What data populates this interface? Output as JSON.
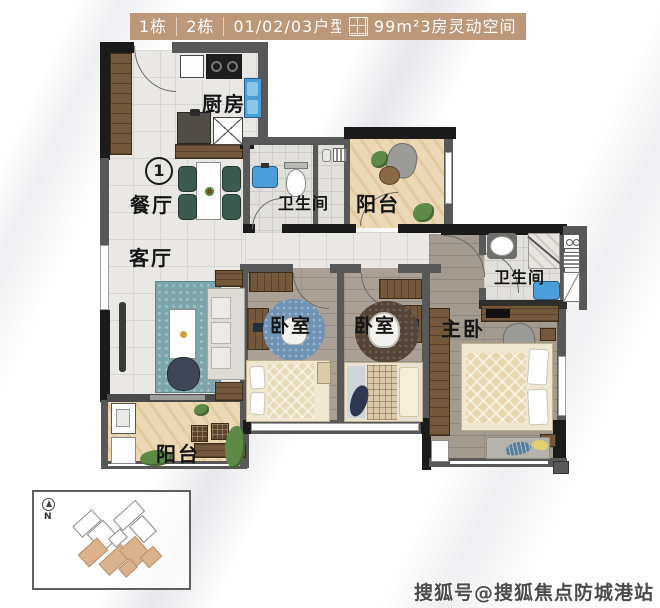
{
  "header": {
    "tabs": [
      "1栋",
      "2栋",
      "01/02/03户型"
    ],
    "area_text": "99m²3房灵动空间",
    "accent_color": "#bc9778"
  },
  "plan": {
    "unit_marker": "1",
    "compass": "N",
    "labels": {
      "kitchen": "厨房",
      "dining": "餐厅",
      "living": "客厅",
      "bathroom": "卫生间",
      "balcony": "阳台",
      "bedroom": "卧室",
      "master_bedroom": "主卧"
    }
  },
  "watermark": "搜狐号@搜狐焦点防城港站",
  "colors": {
    "wall": "#585858",
    "wall_dark": "#1b1b1b",
    "accent": "#bc9778",
    "balcony_marble": "#ead9b4",
    "wood_floor": "#aaa095",
    "sink_blue": "#4a9fd8"
  }
}
